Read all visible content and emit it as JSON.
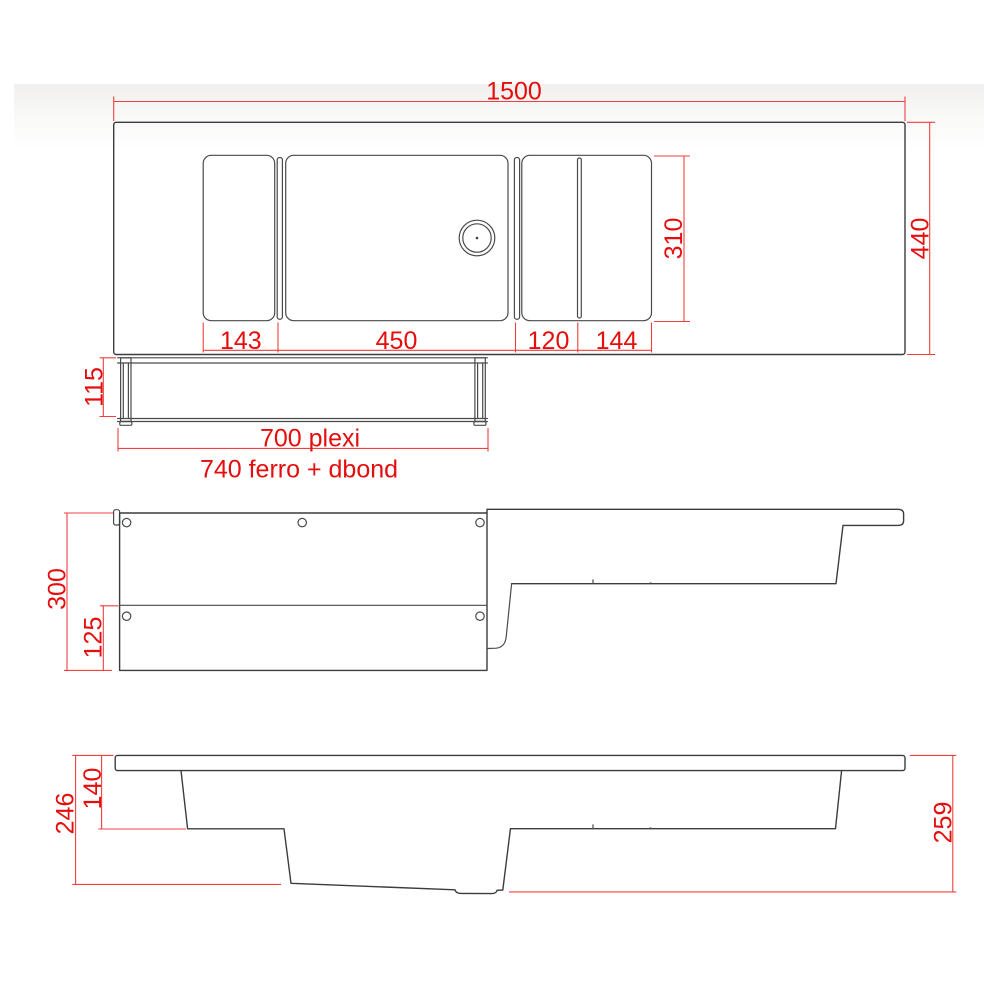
{
  "drawing": {
    "kind": "technical-dimension-drawing",
    "subject": "washbasin countertop with shelf - top, front and side elevation views",
    "colors": {
      "dimension_red": "#e60d0d",
      "outline": "#3c3c3c",
      "background": "#ffffff"
    },
    "dimensions": {
      "top_width": "1500",
      "top_depth": "440",
      "basin_zone_depth": "310",
      "seg_left": "143",
      "seg_basin": "450",
      "seg_mid": "120",
      "seg_right": "144",
      "shelf_height": "115",
      "shelf_width_label": "700 plexi",
      "frame_width_label": "740 ferro + dbond",
      "front_panel_height": "300",
      "front_panel_lower": "125",
      "side_depth_left": "246",
      "side_depth_upper": "140",
      "side_depth_right": "259"
    }
  }
}
